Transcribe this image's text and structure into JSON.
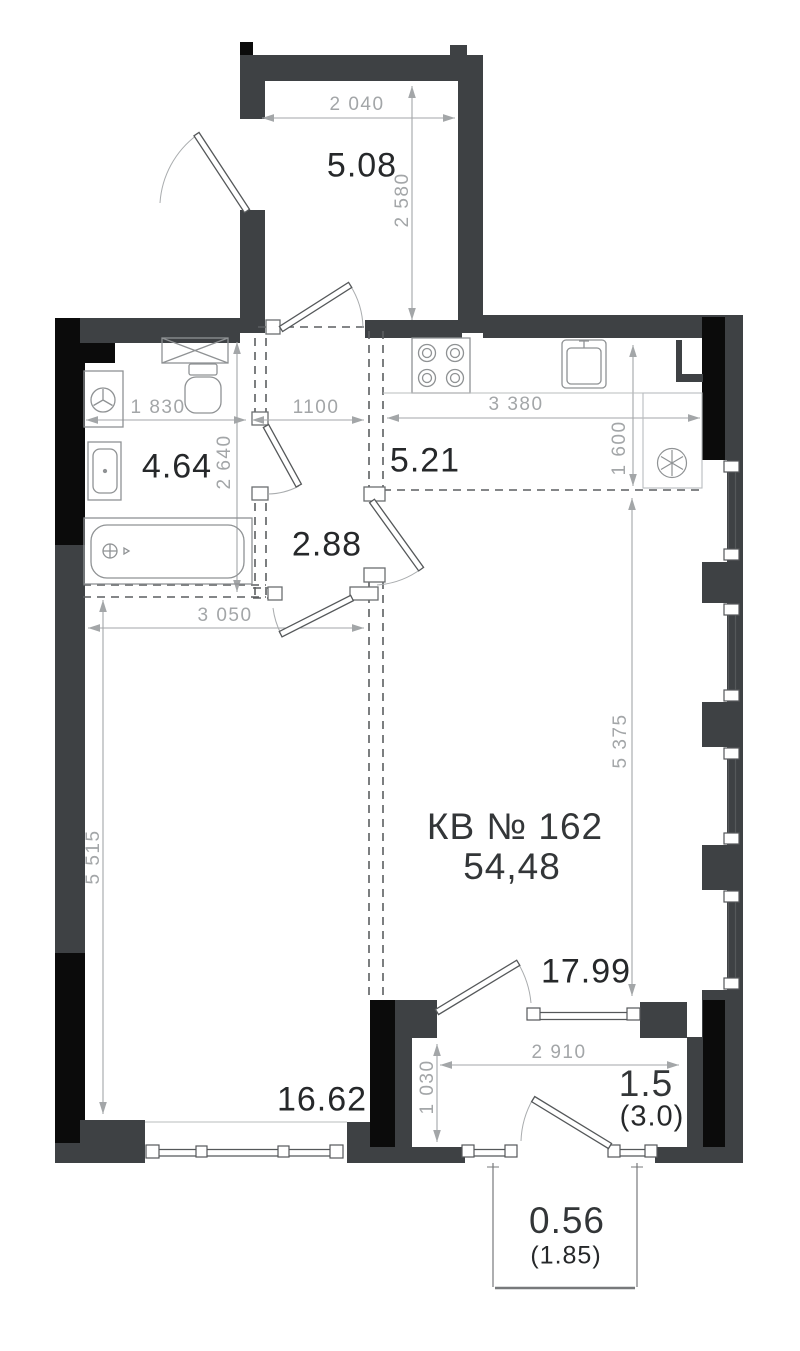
{
  "plan": {
    "apartment": {
      "label": "КВ № 162",
      "area": "54,48"
    },
    "rooms": {
      "entry": {
        "area": "5.08",
        "width": "2 040",
        "height": "2 580"
      },
      "bathroom": {
        "area": "4.64",
        "width": "1 830",
        "height": "2 640"
      },
      "hallway": {
        "area": "2.88",
        "width": "1100"
      },
      "kitchen": {
        "area": "5.21",
        "width": "3 380",
        "height": "1 600"
      },
      "bedroom": {
        "area": "16.62",
        "width": "3 050",
        "height": "5 515"
      },
      "living": {
        "area": "17.99",
        "height": "5 375"
      },
      "loggia": {
        "area": "1.5",
        "area_full": "(3.0)",
        "width": "2 910",
        "height": "1 030"
      },
      "balcony": {
        "area": "0.56",
        "area_full": "(1.85)"
      }
    },
    "colors": {
      "wall": "#3E4144",
      "wall_black": "#0B0B0B",
      "dimension": "#A3A6A8",
      "label": "#26282A"
    },
    "fixtures": [
      "washing-machine",
      "toilet",
      "sink",
      "bathtub",
      "vent-shaft",
      "stove",
      "kitchen-sink",
      "ventilation-fan"
    ]
  }
}
